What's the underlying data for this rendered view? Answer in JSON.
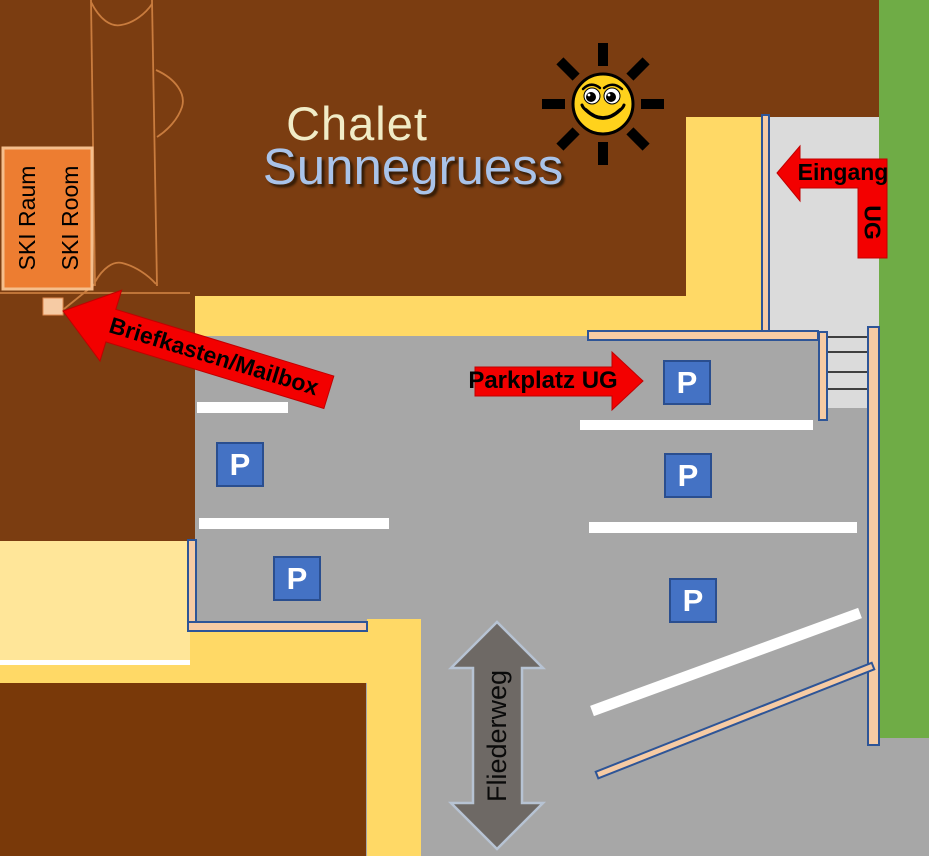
{
  "map_title": {
    "line1": "Chalet",
    "line2": "Sunnegruess"
  },
  "building_labels": {
    "ski_room_de": "SKI Raum",
    "ski_room_en": "SKI Room"
  },
  "annotations": {
    "mailbox_arrow": "Briefkasten/Mailbox",
    "garage_arrow": "Parkplatz UG",
    "entrance_arrow": "Eingang",
    "entrance_arrow_sub": "UG",
    "street_name": "Fliederweg",
    "parking_sign": "P"
  },
  "icons": {
    "sun": "smiling-sun-icon",
    "mailbox_marker": "mailbox-marker",
    "stairs": "stairs-icon"
  },
  "colors": {
    "roof_brown": "#7B3D11",
    "roof_brown_lower": "#793909",
    "path_yellow": "#FFD966",
    "path_yellow_light": "#FFE699",
    "asphalt_gray": "#A7A7A7",
    "walkway_gray": "#DBDBDB",
    "grass_green": "#6FAC46",
    "wall_fill": "#F6CBA4",
    "wall_stroke": "#2E5597",
    "sign_blue": "#4472C4",
    "sign_stroke": "#2A4E8F",
    "arrow_red": "#F30000",
    "arrow_red_dark": "#C00000",
    "street_arrow_gray": "#6E6965",
    "street_arrow_stroke": "#B7C3D3",
    "sun_yellow": "#FFD21C",
    "title_cream": "#F1ECC7",
    "title_blue": "#A9C3E9",
    "outline_orange": "#C97C3E",
    "ski_orange": "#ED7D31",
    "ski_border": "#F5BE8C",
    "line_white": "#FFFFFF",
    "step_gray": "#3F3F3F"
  }
}
